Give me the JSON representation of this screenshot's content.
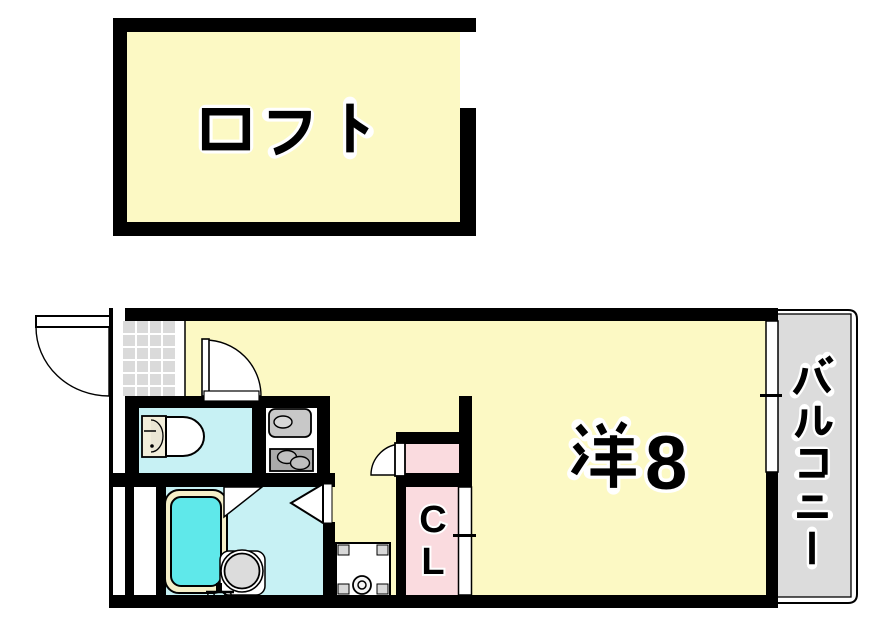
{
  "title": "1K apartment floor plan with loft",
  "rooms": {
    "loft": {
      "label": "ロフト"
    },
    "main": {
      "label": "洋8",
      "kanji": "洋",
      "digit": "8"
    },
    "balcony": {
      "label": "バルコニー"
    },
    "closet": {
      "label": "CL",
      "letters": [
        "C",
        "L"
      ]
    }
  },
  "colors": {
    "room_yellow": "#FCF9C4",
    "wet_area_cyan": "#C7F1F4",
    "bathtub_cyan": "#5FE8EA",
    "tub_rim_cream": "#F5EFC8",
    "closet_pink": "#FADBDF",
    "balcony_gray": "#DCDCDC",
    "entrance_tile_gray": "#DADADA",
    "wall_black": "#000000"
  },
  "fixtures": {
    "entrance": "genkan-tile-area",
    "toilet": "toilet",
    "kitchen_sink": "kitchen-sink",
    "stove": "two-burner-stove",
    "bathtub": "bathtub",
    "washbasin": "round-washbasin",
    "washing_machine": "washing-machine-pan",
    "window": "sliding-window",
    "closet_door": "sliding-door"
  }
}
